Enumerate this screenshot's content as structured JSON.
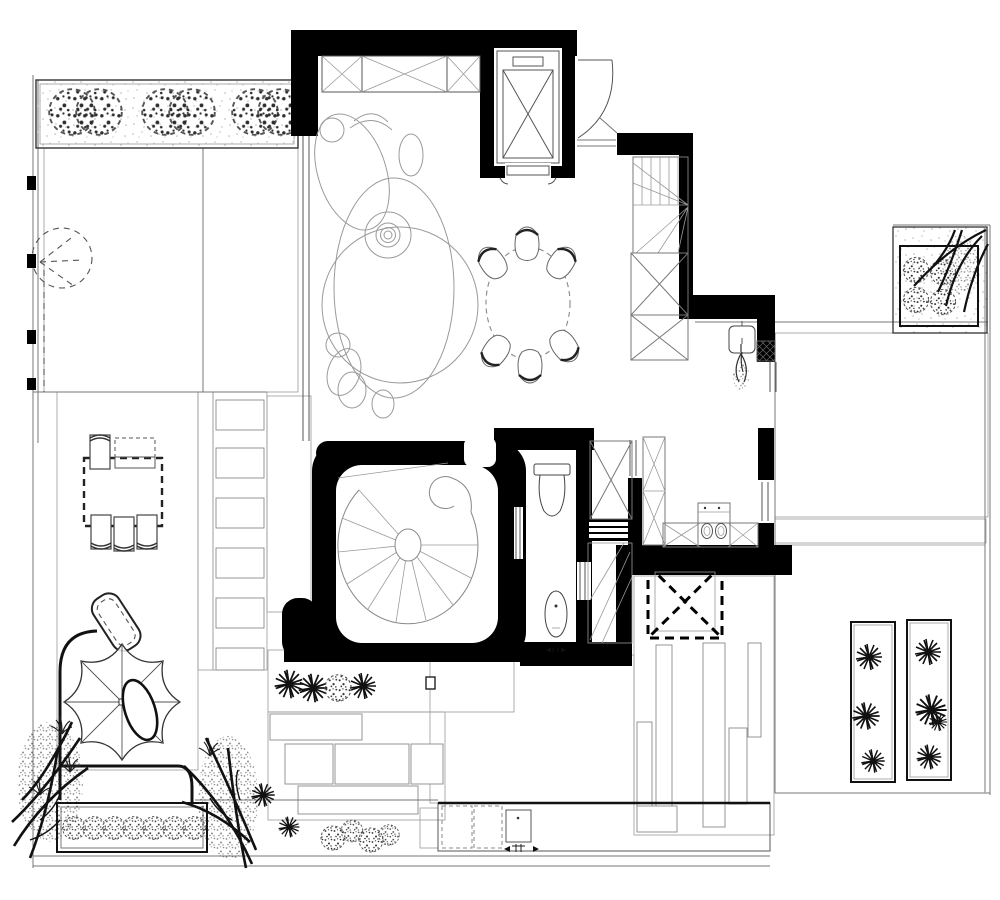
{
  "meta": {
    "kind": "architectural-floor-plan",
    "style": "black-and-white CAD plan, top view",
    "paper_size_px": [
      1000,
      900
    ]
  },
  "palette": {
    "paper": "#ffffff",
    "wall": "#000000",
    "ink": "#111111",
    "line": "#777777",
    "faint": "#9a9a9a"
  },
  "rooms": {
    "living_room": {
      "label": "Living room",
      "features": [
        "organic curved sofa composition",
        "concentric round side table"
      ]
    },
    "entry": {
      "label": "Entry",
      "features": [
        "swing door arc beside elevator"
      ]
    },
    "elevator": {
      "label": "Elevator",
      "symbol": "double rectangle with X",
      "door_side": "bottom"
    },
    "wardrobe_top": {
      "label": "Built-in wardrobe",
      "cells_with_x": 3
    },
    "winder_staircase": {
      "label": "Winder staircase",
      "risers": 11,
      "fan_treads": 5
    },
    "stair_closets": {
      "label": "Storage closets under stair",
      "count": 2,
      "symbol": "rect with X"
    },
    "dining": {
      "label": "Dining area",
      "table": "round, dashed outline",
      "chairs": 6
    },
    "kitchen": {
      "label": "Kitchen",
      "features": [
        "tall cabinet with X",
        "counter with X cabinets",
        "cooktop with 2 burners"
      ]
    },
    "bathroom": {
      "label": "Bathroom",
      "features": [
        "toilet with tank",
        "oval floor fixture",
        "drain arrow symbol"
      ]
    },
    "spiral_room": {
      "label": "Curved-wall lounge",
      "features": [
        "spiral staircase, 10 treads",
        "thick rounded black walls"
      ]
    },
    "service_steps": {
      "label": "Service steps",
      "bars": 3
    },
    "side_closet": {
      "label": "Closet beside bathroom",
      "symbol": "rect with X"
    },
    "skylight": {
      "label": "Skylight opening over pebble court",
      "symbol": "bold dashed square with dashed X"
    }
  },
  "outdoor": {
    "nw_garden": {
      "label": "North-west garden",
      "planter_shrubs": 6,
      "surfaces": [
        "pebble paving",
        "sand stipple"
      ],
      "dashed_tree": 1,
      "wall_ticks": 4
    },
    "west_deck": {
      "label": "West wood deck",
      "surface": "wood planks",
      "dining_table": "dashed rectangle",
      "chairs": 4,
      "bench": 1
    },
    "stepping_path": {
      "label": "Stepping-stone path",
      "slabs": 6,
      "bed": "pebbles"
    },
    "ramp": {
      "label": "Hatched ramp strip",
      "fill": "diagonal hatch"
    },
    "umbrella_lounge": {
      "label": "Parasol lounge",
      "umbrella_ribs": 8,
      "lounge_chair": 1,
      "grass_tufts": 4
    },
    "sw_planter_bed": {
      "label": "South-west planter bed",
      "shrubs": 7,
      "trees": 2,
      "starburst_plants": 2
    },
    "south_court": {
      "label": "South court",
      "starburst_plants": 3,
      "shrub": 1,
      "surfaces": [
        "pebbles",
        "stone slabs",
        "sand"
      ]
    },
    "se_path": {
      "label": "South-east plank-stone path",
      "plank_stones": 6,
      "bed": "pebbles"
    },
    "equipment_strip": {
      "label": "Bottom equipment strip",
      "dashed_units": 2,
      "drain_box": 1,
      "shrub_cluster": 4
    },
    "east_terrace": {
      "label": "East tile terrace",
      "surface": "large tiles"
    },
    "east_deck": {
      "label": "East wood deck",
      "surface": "wood planks",
      "planter_boxes": 2,
      "starburst_clusters": 7
    },
    "ne_planter": {
      "label": "North-east planter box",
      "shrubs": 4,
      "tree": 1
    },
    "wall_fixture": {
      "label": "Wall-mounted basin with plant",
      "hatched_pier": 1
    }
  }
}
